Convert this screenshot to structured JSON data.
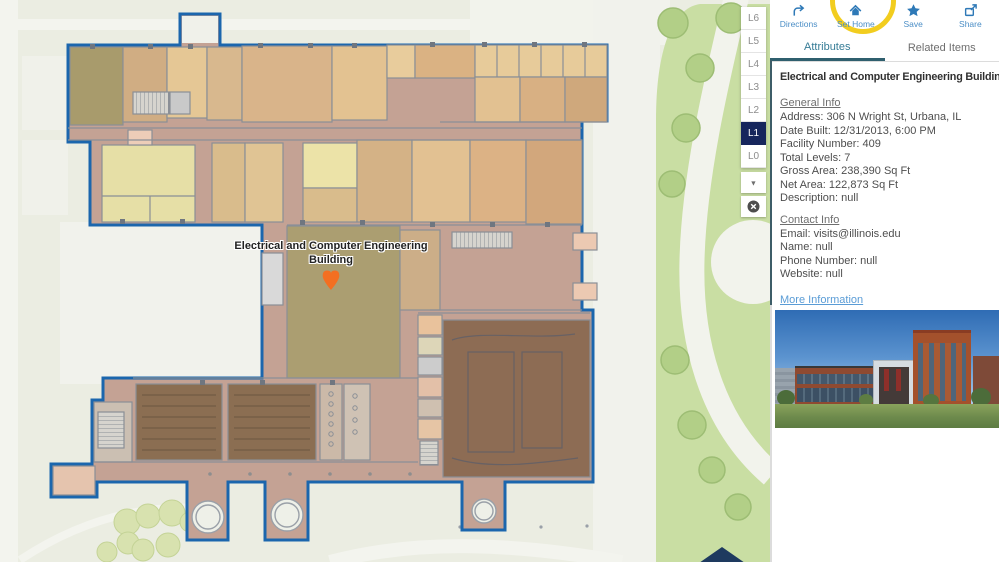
{
  "map": {
    "building_label": "Electrical and Computer Engineering Building",
    "marker_icon": "location-pin-icon",
    "levels": {
      "selected": "L1",
      "items": [
        {
          "label": "L6"
        },
        {
          "label": "L5"
        },
        {
          "label": "L4"
        },
        {
          "label": "L3"
        },
        {
          "label": "L2"
        },
        {
          "label": "L1"
        },
        {
          "label": "L0"
        }
      ],
      "collapse_icon": "chevron-down-icon",
      "close_icon": "close-icon",
      "collapse_glyph": "▼"
    }
  },
  "toolbar": {
    "items": [
      {
        "label": "Directions",
        "icon": "directions-arrow-icon"
      },
      {
        "label": "Set Home",
        "icon": "home-icon",
        "highlighted": true
      },
      {
        "label": "Save",
        "icon": "star-icon"
      },
      {
        "label": "Share",
        "icon": "share-icon"
      }
    ]
  },
  "tabs": {
    "active": "Attributes",
    "items": [
      {
        "label": "Attributes"
      },
      {
        "label": "Related Items"
      }
    ]
  },
  "attributes": {
    "title": "Electrical and Computer Engineering Building",
    "sections": [
      {
        "heading": "General Info",
        "lines": [
          "Address: 306 N Wright St, Urbana, IL",
          "Date Built: 12/31/2013, 6:00 PM",
          "Facility Number: 409",
          "Total Levels: 7",
          "Gross Area: 238,390 Sq Ft",
          "Net Area: 122,873 Sq Ft",
          "Description: null"
        ]
      },
      {
        "heading": "Contact Info",
        "lines": [
          "Email: visits@illinois.edu",
          "Name: null",
          "Phone Number: null",
          "Website: null"
        ]
      }
    ],
    "more_link": "More Information",
    "photo": "building-photo"
  },
  "colors": {
    "accent_blue": "#2e79b7",
    "building_outline_blue": "#1b66ad",
    "selected_level_navy": "#16265c",
    "highlight_yellow": "#f2cd1f",
    "marker_orange": "#f36f21",
    "nav_arrow_navy": "#1e3a5f",
    "lawn_green": "#c9dea3",
    "corridor_mauve": "#c4a294"
  }
}
